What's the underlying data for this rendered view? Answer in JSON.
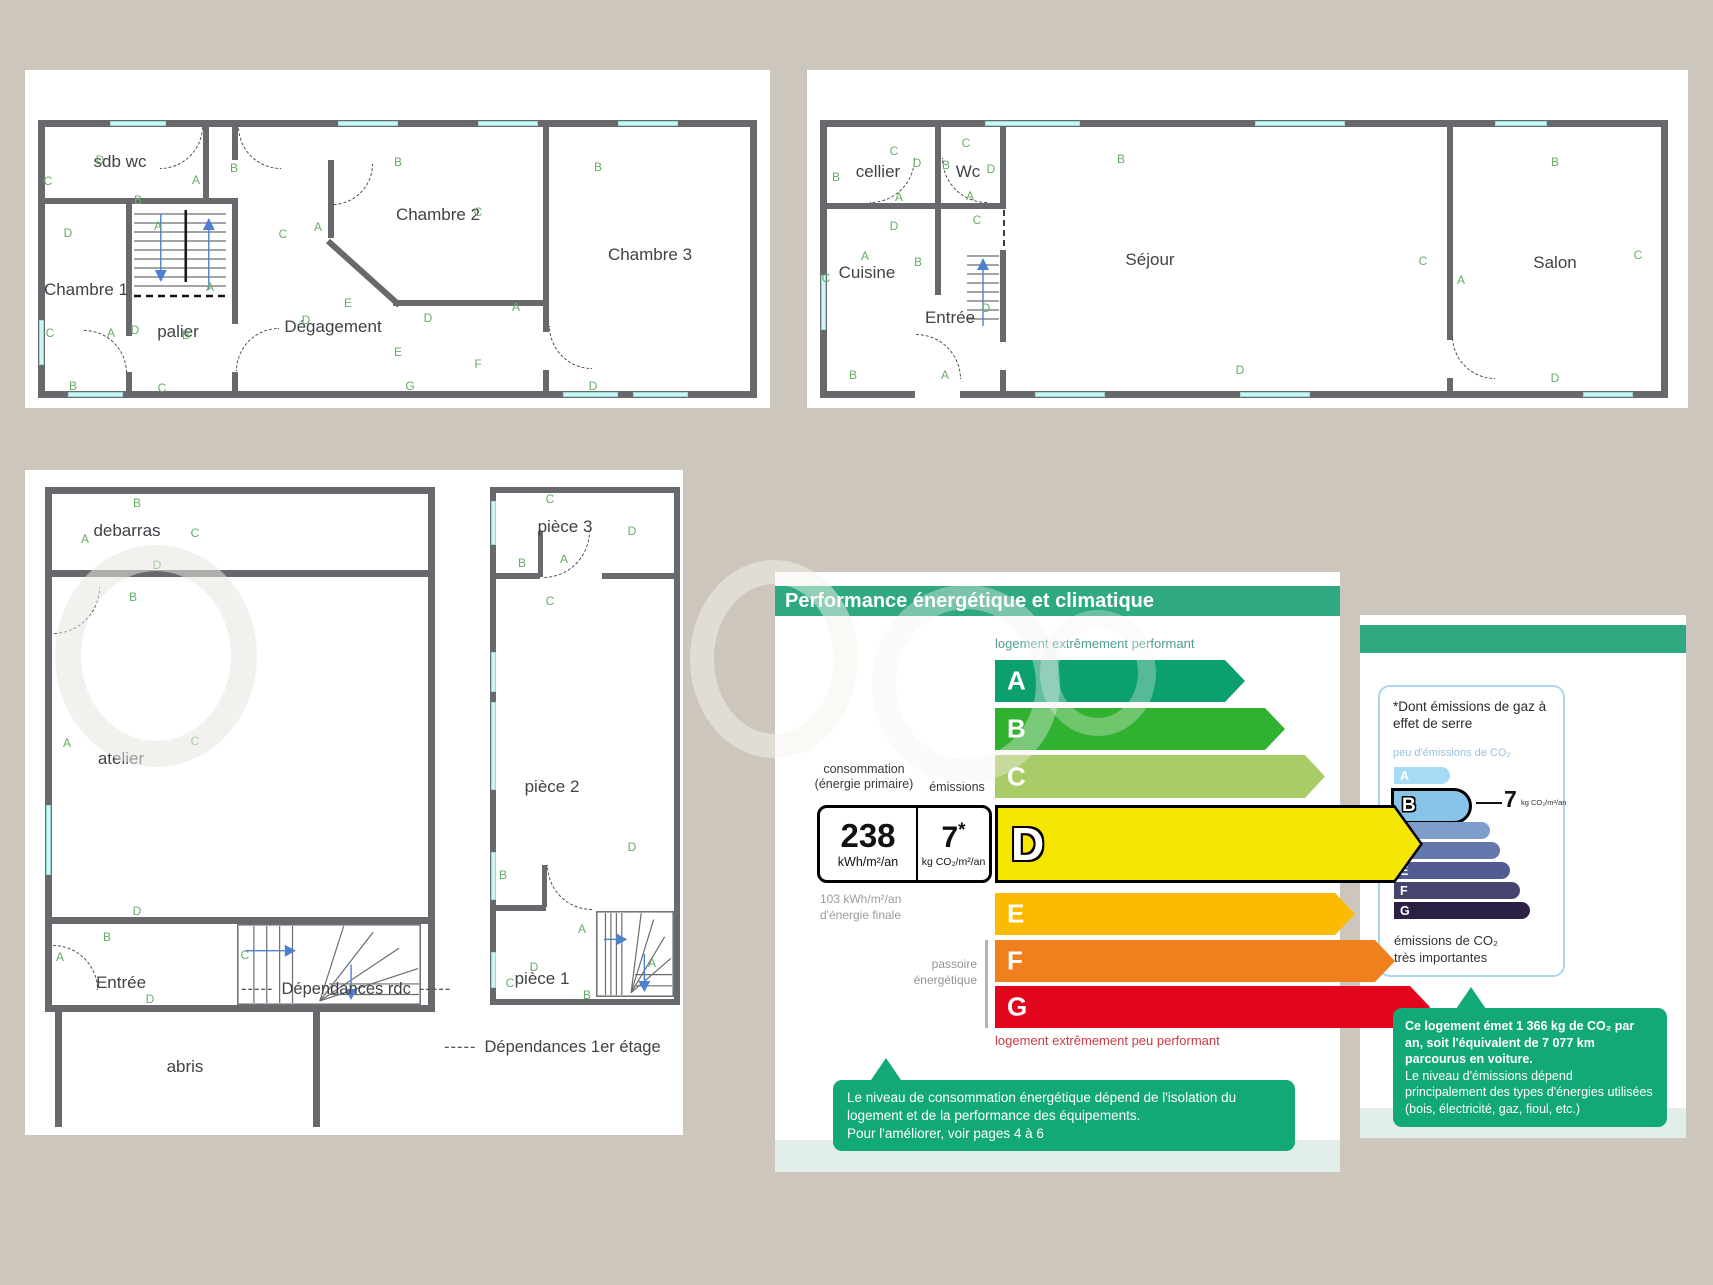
{
  "colors": {
    "background": "#cdc6bc",
    "header_green": "#2fa982",
    "callout_green": "#13a878",
    "footer_green": "#e2efe8",
    "wall_gray": "#67696c",
    "window_cyan": "#c9f6f4",
    "marker_green": "#64ad64"
  },
  "captions": {
    "dashes": "-----",
    "dep_rdc": "Dépendances rdc",
    "dep_etage": "Dépendances 1er étage"
  },
  "plans": {
    "etage": {
      "x": 38,
      "y": 120,
      "w": 719,
      "h": 278,
      "rooms": [
        {
          "label": "sdb wc",
          "x": 82,
          "y": 42
        },
        {
          "label": "Chambre 1",
          "x": 48,
          "y": 170
        },
        {
          "label": "palier",
          "x": 140,
          "y": 212
        },
        {
          "label": "Dégagement",
          "x": 295,
          "y": 207
        },
        {
          "label": "Chambre 2",
          "x": 400,
          "y": 95
        },
        {
          "label": "Chambre 3",
          "x": 612,
          "y": 135
        }
      ],
      "markers": [
        {
          "t": "D",
          "x": 62,
          "y": 40
        },
        {
          "t": "C",
          "x": 10,
          "y": 61
        },
        {
          "t": "B",
          "x": 100,
          "y": 80
        },
        {
          "t": "A",
          "x": 158,
          "y": 60
        },
        {
          "t": "B",
          "x": 196,
          "y": 48
        },
        {
          "t": "B",
          "x": 360,
          "y": 42
        },
        {
          "t": "B",
          "x": 560,
          "y": 47
        },
        {
          "t": "D",
          "x": 30,
          "y": 113
        },
        {
          "t": "A",
          "x": 120,
          "y": 106
        },
        {
          "t": "C",
          "x": 245,
          "y": 114
        },
        {
          "t": "A",
          "x": 280,
          "y": 107
        },
        {
          "t": "C",
          "x": 440,
          "y": 92
        },
        {
          "t": "A",
          "x": 172,
          "y": 167
        },
        {
          "t": "E",
          "x": 310,
          "y": 183
        },
        {
          "t": "D",
          "x": 268,
          "y": 200
        },
        {
          "t": "D",
          "x": 390,
          "y": 198
        },
        {
          "t": "A",
          "x": 478,
          "y": 187
        },
        {
          "t": "C",
          "x": 12,
          "y": 213
        },
        {
          "t": "A",
          "x": 73,
          "y": 213
        },
        {
          "t": "D",
          "x": 97,
          "y": 210
        },
        {
          "t": "B",
          "x": 148,
          "y": 215
        },
        {
          "t": "E",
          "x": 360,
          "y": 232
        },
        {
          "t": "F",
          "x": 440,
          "y": 244
        },
        {
          "t": "B",
          "x": 35,
          "y": 266
        },
        {
          "t": "C",
          "x": 124,
          "y": 268
        },
        {
          "t": "G",
          "x": 372,
          "y": 266
        },
        {
          "t": "D",
          "x": 555,
          "y": 266
        }
      ],
      "walls": [
        [
          0,
          0,
          719,
          7
        ],
        [
          0,
          271,
          719,
          7
        ],
        [
          0,
          0,
          7,
          278
        ],
        [
          712,
          0,
          7,
          278
        ],
        [
          165,
          0,
          6,
          78
        ],
        [
          0,
          78,
          200,
          6
        ],
        [
          194,
          0,
          6,
          40
        ],
        [
          194,
          84,
          6,
          120
        ],
        [
          194,
          252,
          6,
          26
        ],
        [
          88,
          84,
          6,
          132
        ],
        [
          88,
          252,
          6,
          26
        ],
        [
          290,
          40,
          6,
          78
        ],
        [
          355,
          180,
          150,
          6
        ],
        [
          505,
          0,
          6,
          212
        ],
        [
          505,
          250,
          6,
          28
        ]
      ],
      "diags": [
        {
          "x": 290,
          "y": 118,
          "len": 96,
          "ang": 42
        }
      ],
      "wins": [
        [
          72,
          1,
          56,
          5
        ],
        [
          300,
          1,
          60,
          5
        ],
        [
          440,
          1,
          60,
          5
        ],
        [
          580,
          1,
          60,
          5
        ],
        [
          30,
          272,
          55,
          5
        ],
        [
          525,
          272,
          55,
          5
        ],
        [
          595,
          272,
          55,
          5
        ],
        [
          1,
          200,
          5,
          45
        ]
      ],
      "doors": [
        [
          122,
          6,
          42,
          "br"
        ],
        [
          200,
          6,
          42,
          "bl"
        ],
        [
          294,
          44,
          40,
          "br"
        ],
        [
          46,
          210,
          42,
          "tr"
        ],
        [
          198,
          208,
          42,
          "tl"
        ],
        [
          511,
          206,
          42,
          "bl"
        ]
      ],
      "stairs": [
        {
          "x": 94,
          "y": 86,
          "w": 96,
          "h": 92,
          "type": "v"
        }
      ]
    },
    "rdc": {
      "x": 820,
      "y": 120,
      "w": 848,
      "h": 278,
      "rooms": [
        {
          "label": "cellier",
          "x": 58,
          "y": 52
        },
        {
          "label": "Wc",
          "x": 148,
          "y": 52
        },
        {
          "label": "Cuisine",
          "x": 47,
          "y": 153
        },
        {
          "label": "Entrée",
          "x": 130,
          "y": 198
        },
        {
          "label": "Séjour",
          "x": 330,
          "y": 140
        },
        {
          "label": "Salon",
          "x": 735,
          "y": 143
        }
      ],
      "markers": [
        {
          "t": "C",
          "x": 74,
          "y": 31
        },
        {
          "t": "B",
          "x": 16,
          "y": 57
        },
        {
          "t": "D",
          "x": 97,
          "y": 43
        },
        {
          "t": "B",
          "x": 126,
          "y": 45
        },
        {
          "t": "C",
          "x": 146,
          "y": 23
        },
        {
          "t": "D",
          "x": 171,
          "y": 49
        },
        {
          "t": "A",
          "x": 79,
          "y": 77
        },
        {
          "t": "A",
          "x": 150,
          "y": 76
        },
        {
          "t": "C",
          "x": 157,
          "y": 100
        },
        {
          "t": "D",
          "x": 74,
          "y": 106
        },
        {
          "t": "A",
          "x": 45,
          "y": 136
        },
        {
          "t": "B",
          "x": 98,
          "y": 142
        },
        {
          "t": "C",
          "x": 6,
          "y": 158
        },
        {
          "t": "B",
          "x": 301,
          "y": 39
        },
        {
          "t": "C",
          "x": 603,
          "y": 141
        },
        {
          "t": "A",
          "x": 641,
          "y": 160
        },
        {
          "t": "B",
          "x": 735,
          "y": 42
        },
        {
          "t": "C",
          "x": 818,
          "y": 135
        },
        {
          "t": "D",
          "x": 735,
          "y": 258
        },
        {
          "t": "D",
          "x": 420,
          "y": 250
        },
        {
          "t": "B",
          "x": 33,
          "y": 255
        },
        {
          "t": "A",
          "x": 125,
          "y": 255
        },
        {
          "t": "D",
          "x": 166,
          "y": 188
        }
      ],
      "walls": [
        [
          0,
          0,
          848,
          7
        ],
        [
          0,
          271,
          95,
          7
        ],
        [
          140,
          271,
          708,
          7
        ],
        [
          0,
          0,
          7,
          278
        ],
        [
          841,
          0,
          7,
          278
        ],
        [
          115,
          0,
          6,
          83
        ],
        [
          0,
          83,
          186,
          6
        ],
        [
          180,
          0,
          6,
          83
        ],
        [
          115,
          83,
          6,
          92
        ],
        [
          180,
          130,
          6,
          92
        ],
        [
          180,
          250,
          6,
          28
        ],
        [
          627,
          0,
          6,
          220
        ],
        [
          627,
          258,
          6,
          20
        ]
      ],
      "diags": [],
      "dashes": [
        [
          183,
          90,
          2,
          36
        ]
      ],
      "wins": [
        [
          165,
          1,
          95,
          5
        ],
        [
          435,
          1,
          90,
          5
        ],
        [
          675,
          1,
          52,
          5
        ],
        [
          215,
          272,
          70,
          5
        ],
        [
          420,
          272,
          70,
          5
        ],
        [
          763,
          272,
          50,
          5
        ],
        [
          1,
          155,
          5,
          55
        ]
      ],
      "doors": [
        [
          50,
          38,
          44,
          "br"
        ],
        [
          122,
          38,
          44,
          "bl"
        ],
        [
          96,
          214,
          44,
          "tr"
        ],
        [
          632,
          216,
          42,
          "bl"
        ]
      ],
      "stairs": [
        {
          "x": 146,
          "y": 130,
          "w": 34,
          "h": 80,
          "type": "up"
        }
      ]
    },
    "dep_rdc": {
      "x": 45,
      "y": 487,
      "w": 390,
      "h": 640,
      "rooms": [
        {
          "label": "debarras",
          "x": 82,
          "y": 44
        },
        {
          "label": "atelier",
          "x": 76,
          "y": 272
        },
        {
          "label": "Entrée",
          "x": 76,
          "y": 496
        },
        {
          "label": "abris",
          "x": 140,
          "y": 580
        }
      ],
      "markers": [
        {
          "t": "B",
          "x": 92,
          "y": 16
        },
        {
          "t": "A",
          "x": 40,
          "y": 52
        },
        {
          "t": "C",
          "x": 150,
          "y": 46
        },
        {
          "t": "D",
          "x": 112,
          "y": 78
        },
        {
          "t": "B",
          "x": 88,
          "y": 110
        },
        {
          "t": "A",
          "x": 22,
          "y": 256
        },
        {
          "t": "C",
          "x": 150,
          "y": 254
        },
        {
          "t": "D",
          "x": 92,
          "y": 424
        },
        {
          "t": "B",
          "x": 62,
          "y": 450
        },
        {
          "t": "A",
          "x": 15,
          "y": 470
        },
        {
          "t": "C",
          "x": 200,
          "y": 468
        },
        {
          "t": "D",
          "x": 105,
          "y": 512
        }
      ],
      "walls": [
        [
          0,
          0,
          390,
          7
        ],
        [
          0,
          0,
          7,
          525
        ],
        [
          383,
          0,
          7,
          525
        ],
        [
          0,
          518,
          390,
          7
        ],
        [
          0,
          83,
          390,
          7
        ],
        [
          0,
          430,
          390,
          7
        ],
        [
          10,
          525,
          7,
          115
        ],
        [
          268,
          525,
          7,
          115
        ]
      ],
      "diags": [],
      "wins": [
        [
          1,
          318,
          5,
          70
        ]
      ],
      "doors": [
        [
          8,
          100,
          46,
          "br"
        ],
        [
          8,
          458,
          44,
          "tr"
        ]
      ],
      "stairs": [
        {
          "x": 192,
          "y": 437,
          "w": 184,
          "h": 81,
          "type": "fan"
        }
      ]
    },
    "dep_etage": {
      "x": 490,
      "y": 487,
      "w": 190,
      "h": 518,
      "rooms": [
        {
          "label": "pièce 3",
          "x": 75,
          "y": 40
        },
        {
          "label": "pièce 2",
          "x": 62,
          "y": 300
        },
        {
          "label": "pièce 1",
          "x": 52,
          "y": 492
        }
      ],
      "markers": [
        {
          "t": "C",
          "x": 60,
          "y": 12
        },
        {
          "t": "D",
          "x": 142,
          "y": 44
        },
        {
          "t": "B",
          "x": 32,
          "y": 76
        },
        {
          "t": "A",
          "x": 74,
          "y": 72
        },
        {
          "t": "C",
          "x": 60,
          "y": 114
        },
        {
          "t": "B",
          "x": 13,
          "y": 388
        },
        {
          "t": "D",
          "x": 142,
          "y": 360
        },
        {
          "t": "A",
          "x": 92,
          "y": 442
        },
        {
          "t": "D",
          "x": 44,
          "y": 480
        },
        {
          "t": "C",
          "x": 20,
          "y": 496
        },
        {
          "t": "B",
          "x": 97,
          "y": 508
        },
        {
          "t": "A",
          "x": 162,
          "y": 476
        }
      ],
      "walls": [
        [
          0,
          0,
          190,
          6
        ],
        [
          0,
          512,
          190,
          6
        ],
        [
          0,
          0,
          6,
          518
        ],
        [
          184,
          0,
          6,
          518
        ],
        [
          0,
          86,
          50,
          6
        ],
        [
          112,
          86,
          78,
          6
        ],
        [
          48,
          44,
          5,
          46
        ],
        [
          0,
          418,
          56,
          6
        ],
        [
          52,
          378,
          5,
          42
        ]
      ],
      "diags": [],
      "wins": [
        [
          1,
          14,
          5,
          44
        ],
        [
          1,
          165,
          5,
          40
        ],
        [
          1,
          215,
          5,
          88
        ],
        [
          1,
          365,
          5,
          48
        ],
        [
          1,
          465,
          5,
          36
        ]
      ],
      "doors": [
        [
          53,
          44,
          46,
          "br"
        ],
        [
          57,
          378,
          44,
          "bl"
        ]
      ],
      "stairs": [
        {
          "x": 106,
          "y": 424,
          "w": 78,
          "h": 86,
          "type": "fan"
        }
      ]
    }
  },
  "dpe": {
    "title": "Performance énergétique et climatique",
    "top_label": "logement extrêmement performant",
    "bottom_label": "logement extrêmement peu performant",
    "consumption_label": "consommation\n(énergie primaire)",
    "emissions_label": "émissions",
    "consumption_value": "238",
    "consumption_unit": "kWh/m²/an",
    "emissions_value": "7",
    "emissions_star": "*",
    "emissions_unit": "kg CO₂/m²/an",
    "final_energy": "103 kWh/m²/an\nd'énergie finale",
    "passoire": "passoire\nénergétique",
    "rating": "D",
    "classes": [
      {
        "letter": "A",
        "color": "#0ba06e",
        "w": 250,
        "y": 88,
        "h": 42
      },
      {
        "letter": "B",
        "color": "#30b130",
        "w": 290,
        "y": 136,
        "h": 42
      },
      {
        "letter": "C",
        "color": "#a8cc68",
        "w": 330,
        "y": 183,
        "h": 43
      },
      {
        "letter": "D",
        "color": "#f4e600",
        "w": 428,
        "y": 233,
        "h": 78
      },
      {
        "letter": "E",
        "color": "#fcba00",
        "w": 360,
        "y": 321,
        "h": 42
      },
      {
        "letter": "F",
        "color": "#f0801e",
        "w": 400,
        "y": 368,
        "h": 42
      },
      {
        "letter": "G",
        "color": "#e3051b",
        "w": 435,
        "y": 414,
        "h": 42
      }
    ],
    "callout": "Le niveau de consommation énergétique dépend de l'isolation du logement et de la performance des équipements.\nPour l'améliorer, voir pages 4 à 6"
  },
  "ges": {
    "note_title": "*Dont émissions de gaz à effet de serre",
    "top_label": "peu d'émissions de CO₂",
    "bottom_label": "émissions de CO₂\ntrès importantes",
    "rating": "B",
    "value": "7",
    "unit": "kg CO₂/m²/an",
    "classes": [
      {
        "letter": "A",
        "color": "#a7dbf4",
        "w": 56,
        "y": 80,
        "h": 17
      },
      {
        "letter": "B",
        "color": "#88c3e8",
        "w": 75,
        "y": 101,
        "h": 30
      },
      {
        "letter": "C",
        "color": "#7d9ecb",
        "w": 96,
        "y": 135,
        "h": 17
      },
      {
        "letter": "D",
        "color": "#6478ae",
        "w": 106,
        "y": 155,
        "h": 17
      },
      {
        "letter": "E",
        "color": "#505c92",
        "w": 116,
        "y": 175,
        "h": 17
      },
      {
        "letter": "F",
        "color": "#45446f",
        "w": 126,
        "y": 195,
        "h": 17
      },
      {
        "letter": "G",
        "color": "#2c2145",
        "w": 136,
        "y": 215,
        "h": 17
      }
    ],
    "callout_bold": "Ce logement émet 1 366 kg de CO₂ par an, soit l'équivalent de 7 077 km parcourus en voiture.",
    "callout_rest": "Le niveau d'émissions dépend principalement des types d'énergies utilisées (bois, électricité, gaz, fioul, etc.)"
  }
}
